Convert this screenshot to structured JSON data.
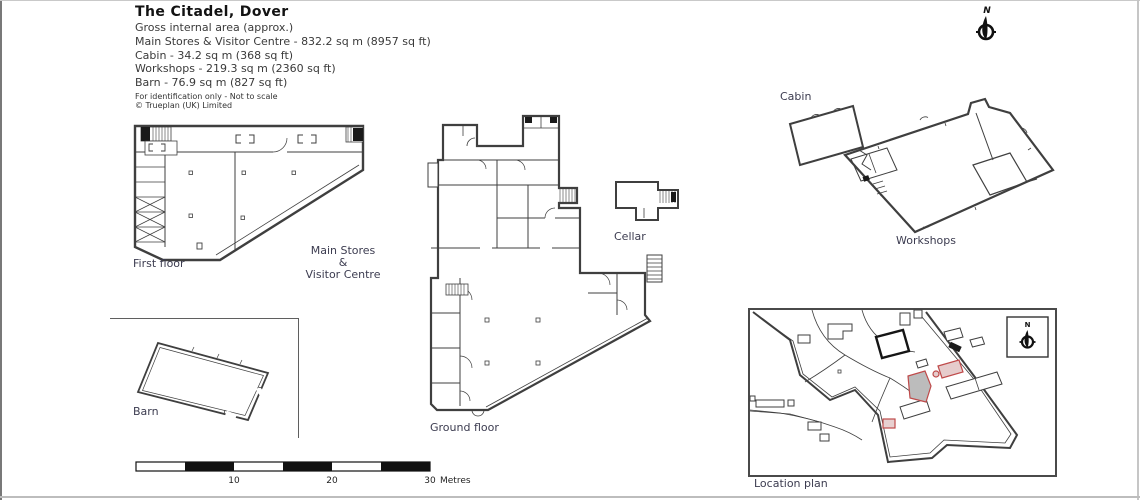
{
  "header": {
    "title": "The Citadel, Dover",
    "subtitle": "Gross internal area (approx.)",
    "area_lines": [
      "Main Stores & Visitor Centre - 832.2 sq m (8957 sq ft)",
      "Cabin - 34.2 sq m (368 sq ft)",
      "Workshops - 219.3 sq m (2360 sq ft)",
      "Barn - 76.9 sq m (827 sq ft)"
    ],
    "disclaimer": "For identification only - Not to scale",
    "copyright": "© Trueplan (UK) Limited"
  },
  "plans": {
    "first_floor": {
      "label": "First floor"
    },
    "main_stores": {
      "line1": "Main Stores",
      "line2": "&",
      "line3": "Visitor Centre"
    },
    "ground_floor": {
      "label": "Ground floor"
    },
    "cellar": {
      "label": "Cellar"
    },
    "cabin": {
      "label": "Cabin"
    },
    "workshops": {
      "label": "Workshops"
    },
    "barn": {
      "label": "Barn"
    },
    "location_plan": {
      "label": "Location plan"
    }
  },
  "compass": {
    "north_label": "N"
  },
  "scale_bar": {
    "ticks": [
      "10",
      "20",
      "30"
    ],
    "unit": "Metres"
  },
  "colors": {
    "line": "#3f3f3f",
    "text": "#3c3c50",
    "accent_red": "#bf4a4a",
    "highlight_fill": "#bcbcbc"
  }
}
